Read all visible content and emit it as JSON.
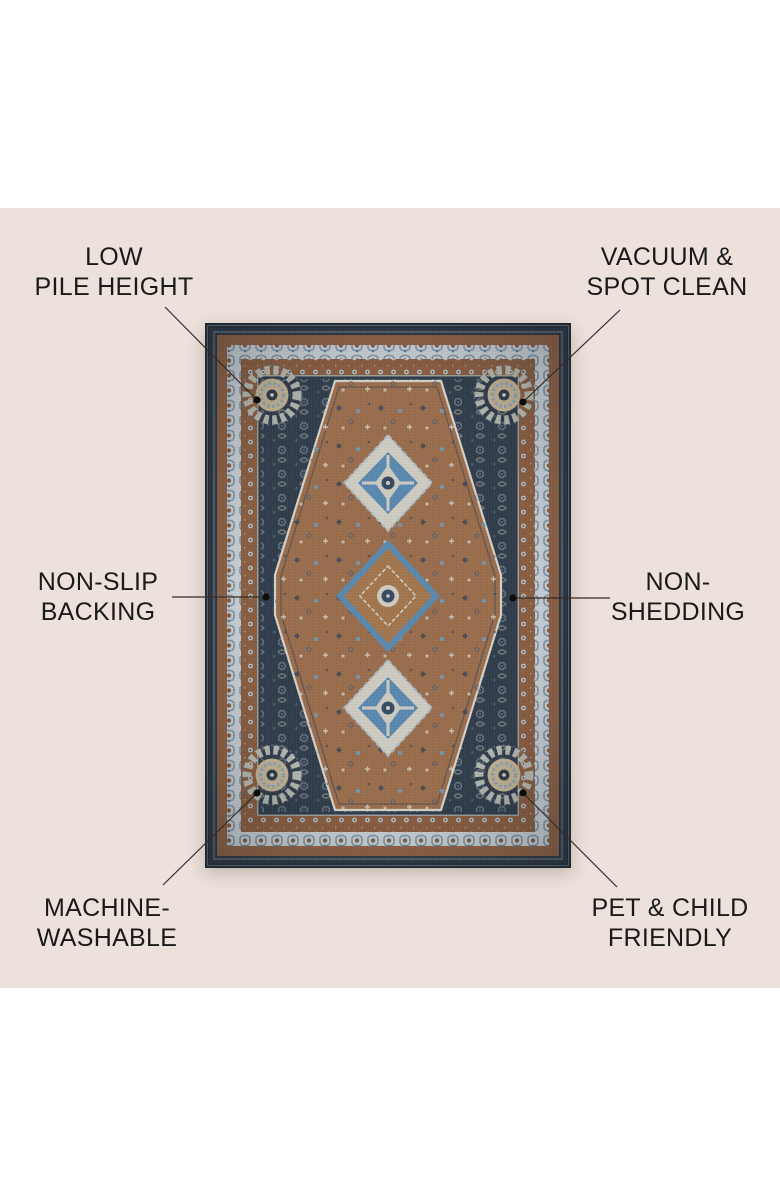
{
  "page": {
    "type": "product-feature-infographic",
    "background_color": "#ffffff",
    "canvas_background_color": "#ece1db",
    "label_text_color": "#1a1a1a",
    "callout_line_color": "#352b24"
  },
  "features": [
    {
      "id": "low-pile-height",
      "line1": "LOW",
      "line2": "PILE HEIGHT"
    },
    {
      "id": "vacuum-spot-clean",
      "line1": "VACUUM &",
      "line2": "SPOT CLEAN"
    },
    {
      "id": "non-slip-backing",
      "line1": "NON-SLIP",
      "line2": "BACKING"
    },
    {
      "id": "non-shedding",
      "line1": "NON-",
      "line2": "SHEDDING"
    },
    {
      "id": "machine-washable",
      "line1": "MACHINE-",
      "line2": "WASHABLE"
    },
    {
      "id": "pet-child-friendly",
      "line1": "PET & CHILD",
      "line2": "FRIENDLY"
    }
  ],
  "rug": {
    "style": "persian-medallion-area-rug",
    "colors": {
      "navy_field": "#323e4c",
      "navy_edge": "#242d38",
      "brown_field": "#9b6e4d",
      "brown_band": "#8a5f43",
      "light_band": "#c7d0d6",
      "cream": "#d2cfc5",
      "medallion_blue": "#5b8ab1"
    }
  }
}
